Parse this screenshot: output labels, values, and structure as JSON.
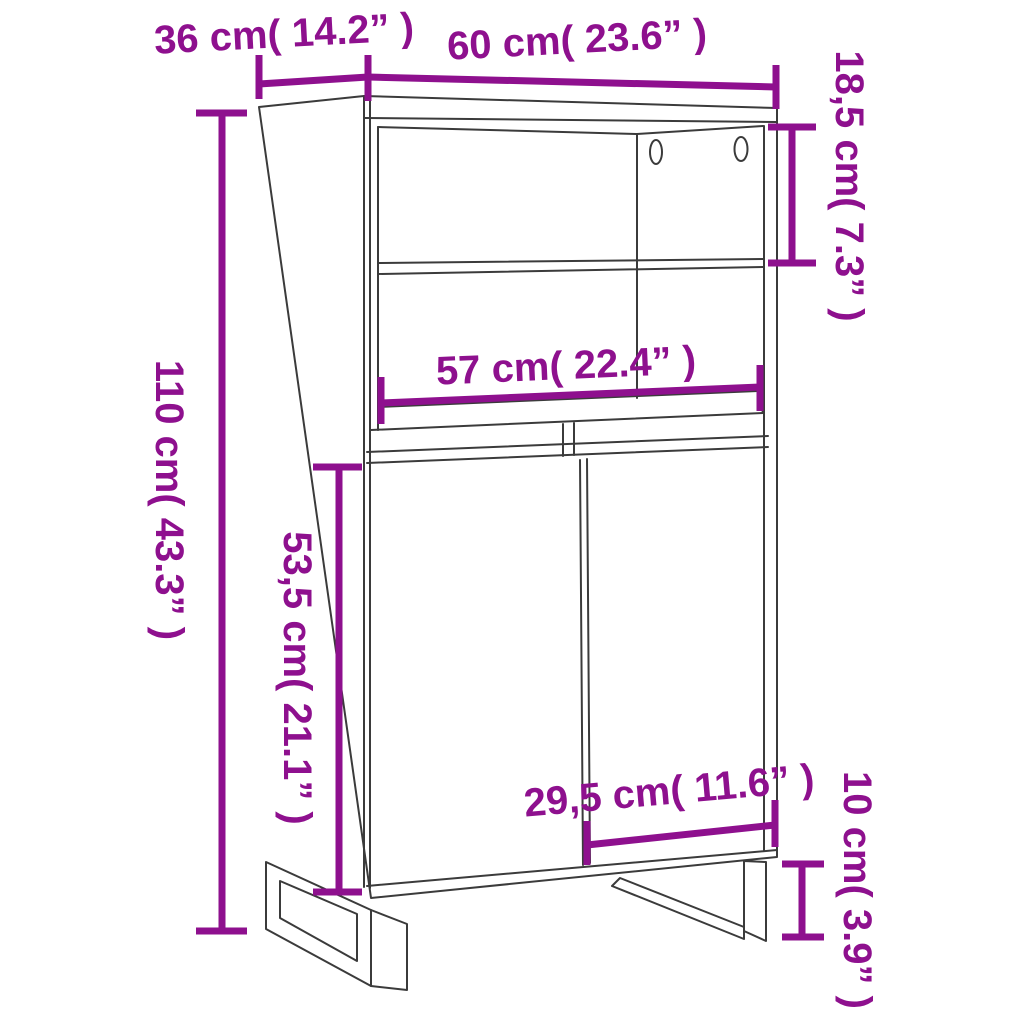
{
  "diagram": {
    "type": "product dimension line drawing",
    "product": "highboard cabinet with open shelves, two doors and metal legs",
    "colors": {
      "dimension_annotation": "#8E108E",
      "line_art": "#3B3B3B",
      "background": "#FFFFFF"
    },
    "dimensions": {
      "depth": {
        "label": "36 cm( 14.2” )",
        "cm": "36",
        "in": "14.2"
      },
      "width": {
        "label": "60 cm( 23.6” )",
        "cm": "60",
        "in": "23.6"
      },
      "shelf_height": {
        "label": "18,5 cm( 7.3” )",
        "cm": "18,5",
        "in": "7.3"
      },
      "height": {
        "label": "110 cm( 43.3” )",
        "cm": "110",
        "in": "43.3"
      },
      "inner_width": {
        "label": "57 cm( 22.4” )",
        "cm": "57",
        "in": "22.4"
      },
      "door_height": {
        "label": "53,5 cm( 21.1” )",
        "cm": "53,5",
        "in": "21.1"
      },
      "door_width": {
        "label": "29,5 cm( 11.6” )",
        "cm": "29,5",
        "in": "11.6"
      },
      "leg_height": {
        "label": "10 cm( 3.9” )",
        "cm": "10",
        "in": "3.9"
      }
    }
  }
}
